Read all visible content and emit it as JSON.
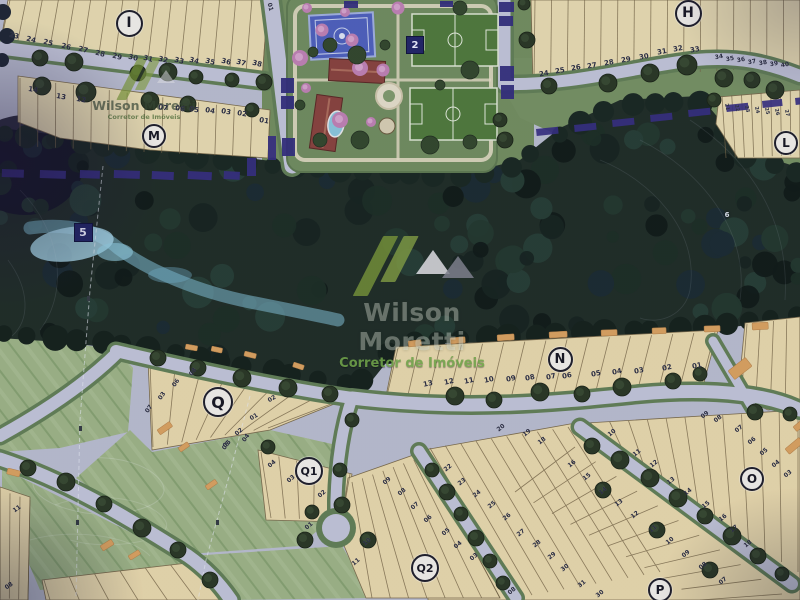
{
  "map_title": "Loteamento masterplan aerial site plan",
  "watermark": {
    "name": "Wilson Moretti",
    "tagline": "Corretor de Imóveis"
  },
  "colors": {
    "lot_fill": "#e8dbaa",
    "road": "#c2c5d9",
    "verge": "#5e7f50",
    "forest": "#1b2a21",
    "creek": "#a5dcec",
    "field": "#9cb580",
    "orange_marker": "#dfa055",
    "boundary_purple": "#332a84",
    "badge_navy": "#1d2268",
    "sport_green": "#4b7a33",
    "court_blue": "#4a5fc2",
    "roof_red": "#8c4038",
    "logo_green": "#7e9c33"
  },
  "badges": [
    {
      "id": "block-I",
      "label": "I",
      "kind": "circle",
      "x": 127,
      "y": 21,
      "d": 23
    },
    {
      "id": "block-M",
      "label": "M",
      "kind": "circle",
      "x": 152,
      "y": 134,
      "d": 20
    },
    {
      "id": "block-H",
      "label": "H",
      "kind": "circle",
      "x": 686,
      "y": 11,
      "d": 23
    },
    {
      "id": "block-L",
      "label": "L",
      "kind": "circle",
      "x": 784,
      "y": 141,
      "d": 20
    },
    {
      "id": "block-N",
      "label": "N",
      "kind": "circle",
      "x": 558,
      "y": 357,
      "d": 21
    },
    {
      "id": "block-Q",
      "label": "Q",
      "kind": "circle",
      "x": 216,
      "y": 400,
      "d": 26
    },
    {
      "id": "block-Q1",
      "label": "Q1",
      "kind": "circle",
      "x": 307,
      "y": 469,
      "d": 24
    },
    {
      "id": "block-Q2",
      "label": "Q2",
      "kind": "circle",
      "x": 423,
      "y": 566,
      "d": 24
    },
    {
      "id": "block-O",
      "label": "O",
      "kind": "circle",
      "x": 750,
      "y": 477,
      "d": 20
    },
    {
      "id": "block-P",
      "label": "P",
      "kind": "circle",
      "x": 658,
      "y": 588,
      "d": 20
    },
    {
      "id": "area-2",
      "label": "2",
      "kind": "square",
      "x": 414,
      "y": 44,
      "d": 16
    },
    {
      "id": "area-5",
      "label": "5",
      "kind": "square",
      "x": 82,
      "y": 231,
      "d": 17
    },
    {
      "id": "area-6",
      "label": "6",
      "kind": "plain",
      "x": 727,
      "y": 215,
      "d": 12
    }
  ],
  "lot_numbers": [
    {
      "b": "I",
      "n": "23",
      "x": 14,
      "y": 36,
      "r": 14
    },
    {
      "b": "I",
      "n": "24",
      "x": 31,
      "y": 40,
      "r": 14
    },
    {
      "b": "I",
      "n": "25",
      "x": 48,
      "y": 43,
      "r": 14
    },
    {
      "b": "I",
      "n": "26",
      "x": 66,
      "y": 47,
      "r": 14
    },
    {
      "b": "I",
      "n": "27",
      "x": 83,
      "y": 50,
      "r": 14
    },
    {
      "b": "I",
      "n": "28",
      "x": 100,
      "y": 54,
      "r": 14
    },
    {
      "b": "I",
      "n": "29",
      "x": 117,
      "y": 57,
      "r": 14
    },
    {
      "b": "I",
      "n": "30",
      "x": 133,
      "y": 58,
      "r": 14
    },
    {
      "b": "I",
      "n": "31",
      "x": 148,
      "y": 59,
      "r": 14
    },
    {
      "b": "I",
      "n": "32",
      "x": 163,
      "y": 60,
      "r": 14
    },
    {
      "b": "I",
      "n": "33",
      "x": 179,
      "y": 61,
      "r": 14
    },
    {
      "b": "I",
      "n": "34",
      "x": 194,
      "y": 61,
      "r": 14
    },
    {
      "b": "I",
      "n": "35",
      "x": 210,
      "y": 62,
      "r": 14
    },
    {
      "b": "I",
      "n": "36",
      "x": 226,
      "y": 62,
      "r": 14
    },
    {
      "b": "I",
      "n": "37",
      "x": 241,
      "y": 63,
      "r": 14
    },
    {
      "b": "I",
      "n": "38",
      "x": 257,
      "y": 64,
      "r": 14
    },
    {
      "b": "I",
      "n": "01",
      "x": 270,
      "y": 7,
      "r": 75,
      "s": 6
    },
    {
      "b": "M",
      "n": "14",
      "x": 33,
      "y": 90,
      "r": 10
    },
    {
      "b": "M",
      "n": "13",
      "x": 61,
      "y": 97,
      "r": 10
    },
    {
      "b": "M",
      "n": "12",
      "x": 81,
      "y": 100,
      "r": 10
    },
    {
      "b": "M",
      "n": "07",
      "x": 163,
      "y": 108,
      "r": 10
    },
    {
      "b": "M",
      "n": "06",
      "x": 180,
      "y": 109,
      "r": 10
    },
    {
      "b": "M",
      "n": "05",
      "x": 194,
      "y": 110,
      "r": 10
    },
    {
      "b": "M",
      "n": "04",
      "x": 210,
      "y": 111,
      "r": 10
    },
    {
      "b": "M",
      "n": "03",
      "x": 226,
      "y": 112,
      "r": 10
    },
    {
      "b": "M",
      "n": "02",
      "x": 242,
      "y": 114,
      "r": 10
    },
    {
      "b": "M",
      "n": "01",
      "x": 264,
      "y": 121,
      "r": 10
    },
    {
      "b": "H",
      "n": "24",
      "x": 544,
      "y": 74,
      "r": -10
    },
    {
      "b": "H",
      "n": "25",
      "x": 560,
      "y": 71,
      "r": -10
    },
    {
      "b": "H",
      "n": "26",
      "x": 576,
      "y": 68,
      "r": -10
    },
    {
      "b": "H",
      "n": "27",
      "x": 592,
      "y": 66,
      "r": -10
    },
    {
      "b": "H",
      "n": "28",
      "x": 609,
      "y": 63,
      "r": -10
    },
    {
      "b": "H",
      "n": "29",
      "x": 626,
      "y": 60,
      "r": -10
    },
    {
      "b": "H",
      "n": "30",
      "x": 644,
      "y": 57,
      "r": -10
    },
    {
      "b": "H",
      "n": "31",
      "x": 662,
      "y": 52,
      "r": -10
    },
    {
      "b": "H",
      "n": "32",
      "x": 678,
      "y": 49,
      "r": -10
    },
    {
      "b": "H",
      "n": "33",
      "x": 695,
      "y": 50,
      "r": -10
    },
    {
      "b": "H",
      "n": "34",
      "x": 719,
      "y": 57,
      "r": -10,
      "s": 6
    },
    {
      "b": "H",
      "n": "35",
      "x": 730,
      "y": 59,
      "r": -10,
      "s": 6
    },
    {
      "b": "H",
      "n": "36",
      "x": 741,
      "y": 60,
      "r": -10,
      "s": 6
    },
    {
      "b": "H",
      "n": "37",
      "x": 752,
      "y": 62,
      "r": -10,
      "s": 6
    },
    {
      "b": "H",
      "n": "38",
      "x": 763,
      "y": 63,
      "r": -10,
      "s": 6
    },
    {
      "b": "H",
      "n": "39",
      "x": 774,
      "y": 64,
      "r": -10,
      "s": 6
    },
    {
      "b": "H",
      "n": "40",
      "x": 785,
      "y": 65,
      "r": -10,
      "s": 6
    },
    {
      "b": "L",
      "n": "21",
      "x": 727,
      "y": 107,
      "r": 78,
      "s": 5
    },
    {
      "b": "L",
      "n": "22",
      "x": 737,
      "y": 108,
      "r": 78,
      "s": 5
    },
    {
      "b": "L",
      "n": "23",
      "x": 747,
      "y": 109,
      "r": 78,
      "s": 5
    },
    {
      "b": "L",
      "n": "24",
      "x": 757,
      "y": 110,
      "r": 78,
      "s": 5
    },
    {
      "b": "L",
      "n": "25",
      "x": 767,
      "y": 111,
      "r": 78,
      "s": 5
    },
    {
      "b": "L",
      "n": "26",
      "x": 777,
      "y": 112,
      "r": 78,
      "s": 5
    },
    {
      "b": "L",
      "n": "27",
      "x": 787,
      "y": 113,
      "r": 78,
      "s": 5
    },
    {
      "b": "N",
      "n": "13",
      "x": 428,
      "y": 384,
      "r": -12
    },
    {
      "b": "N",
      "n": "12",
      "x": 449,
      "y": 382,
      "r": -12
    },
    {
      "b": "N",
      "n": "11",
      "x": 469,
      "y": 381,
      "r": -12
    },
    {
      "b": "N",
      "n": "10",
      "x": 489,
      "y": 380,
      "r": -12
    },
    {
      "b": "N",
      "n": "09",
      "x": 511,
      "y": 379,
      "r": -12
    },
    {
      "b": "N",
      "n": "08",
      "x": 530,
      "y": 378,
      "r": -12
    },
    {
      "b": "N",
      "n": "07",
      "x": 551,
      "y": 377,
      "r": -12
    },
    {
      "b": "N",
      "n": "06",
      "x": 567,
      "y": 376,
      "r": -12
    },
    {
      "b": "N",
      "n": "05",
      "x": 596,
      "y": 374,
      "r": -12
    },
    {
      "b": "N",
      "n": "04",
      "x": 617,
      "y": 372,
      "r": -12
    },
    {
      "b": "N",
      "n": "03",
      "x": 639,
      "y": 371,
      "r": -12
    },
    {
      "b": "N",
      "n": "02",
      "x": 667,
      "y": 368,
      "r": -12
    },
    {
      "b": "N",
      "n": "01",
      "x": 697,
      "y": 366,
      "r": -12
    },
    {
      "b": "R",
      "n": "20",
      "x": 501,
      "y": 428,
      "r": -38,
      "s": 6
    },
    {
      "b": "R",
      "n": "19",
      "x": 527,
      "y": 433,
      "r": -38,
      "s": 6
    },
    {
      "b": "R",
      "n": "18",
      "x": 542,
      "y": 441,
      "r": -38,
      "s": 6
    },
    {
      "b": "R",
      "n": "22",
      "x": 448,
      "y": 468,
      "r": -38,
      "s": 6
    },
    {
      "b": "R",
      "n": "23",
      "x": 462,
      "y": 482,
      "r": -38,
      "s": 6
    },
    {
      "b": "R",
      "n": "24",
      "x": 477,
      "y": 494,
      "r": -38,
      "s": 6
    },
    {
      "b": "R",
      "n": "25",
      "x": 492,
      "y": 505,
      "r": -38,
      "s": 6
    },
    {
      "b": "R",
      "n": "26",
      "x": 507,
      "y": 517,
      "r": -38,
      "s": 6
    },
    {
      "b": "R",
      "n": "27",
      "x": 521,
      "y": 533,
      "r": -38,
      "s": 6
    },
    {
      "b": "R",
      "n": "28",
      "x": 537,
      "y": 544,
      "r": -38,
      "s": 6
    },
    {
      "b": "R",
      "n": "29",
      "x": 552,
      "y": 556,
      "r": -38,
      "s": 6
    },
    {
      "b": "R",
      "n": "30",
      "x": 565,
      "y": 568,
      "r": -38,
      "s": 6
    },
    {
      "b": "O",
      "n": "10",
      "x": 612,
      "y": 433,
      "r": -38,
      "s": 6
    },
    {
      "b": "O",
      "n": "11",
      "x": 637,
      "y": 453,
      "r": -38,
      "s": 6
    },
    {
      "b": "O",
      "n": "12",
      "x": 654,
      "y": 464,
      "r": -38,
      "s": 6
    },
    {
      "b": "O",
      "n": "13",
      "x": 671,
      "y": 481,
      "r": -38,
      "s": 6
    },
    {
      "b": "O",
      "n": "14",
      "x": 688,
      "y": 492,
      "r": -38,
      "s": 6
    },
    {
      "b": "O",
      "n": "15",
      "x": 706,
      "y": 505,
      "r": -38,
      "s": 6
    },
    {
      "b": "O",
      "n": "16",
      "x": 723,
      "y": 518,
      "r": -38,
      "s": 6
    },
    {
      "b": "O",
      "n": "17",
      "x": 734,
      "y": 529,
      "r": -38,
      "s": 6
    },
    {
      "b": "O",
      "n": "18",
      "x": 748,
      "y": 544,
      "r": -38,
      "s": 6
    },
    {
      "b": "O",
      "n": "09",
      "x": 705,
      "y": 415,
      "r": -38,
      "s": 6
    },
    {
      "b": "O",
      "n": "08",
      "x": 718,
      "y": 419,
      "r": -38,
      "s": 6
    },
    {
      "b": "O",
      "n": "07",
      "x": 739,
      "y": 429,
      "r": -38,
      "s": 6
    },
    {
      "b": "O",
      "n": "06",
      "x": 752,
      "y": 441,
      "r": -38,
      "s": 6
    },
    {
      "b": "O",
      "n": "05",
      "x": 764,
      "y": 452,
      "r": -38,
      "s": 6
    },
    {
      "b": "O",
      "n": "04",
      "x": 776,
      "y": 464,
      "r": -38,
      "s": 6
    },
    {
      "b": "O",
      "n": "03",
      "x": 788,
      "y": 474,
      "r": -38,
      "s": 6
    },
    {
      "b": "P",
      "n": "16",
      "x": 572,
      "y": 464,
      "r": -38,
      "s": 6
    },
    {
      "b": "P",
      "n": "15",
      "x": 587,
      "y": 477,
      "r": -38,
      "s": 6
    },
    {
      "b": "P",
      "n": "14",
      "x": 603,
      "y": 491,
      "r": -38,
      "s": 6
    },
    {
      "b": "P",
      "n": "13",
      "x": 619,
      "y": 503,
      "r": -38,
      "s": 6
    },
    {
      "b": "P",
      "n": "12",
      "x": 635,
      "y": 515,
      "r": -38,
      "s": 6
    },
    {
      "b": "P",
      "n": "11",
      "x": 653,
      "y": 529,
      "r": -38,
      "s": 6
    },
    {
      "b": "P",
      "n": "10",
      "x": 670,
      "y": 541,
      "r": -38,
      "s": 6
    },
    {
      "b": "P",
      "n": "09",
      "x": 686,
      "y": 554,
      "r": -38,
      "s": 6
    },
    {
      "b": "P",
      "n": "08",
      "x": 703,
      "y": 566,
      "r": -38,
      "s": 6
    },
    {
      "b": "P",
      "n": "07",
      "x": 723,
      "y": 581,
      "r": -38,
      "s": 6
    },
    {
      "b": "P",
      "n": "31",
      "x": 582,
      "y": 584,
      "r": -38,
      "s": 6
    },
    {
      "b": "P",
      "n": "30",
      "x": 600,
      "y": 594,
      "r": -38,
      "s": 6
    },
    {
      "b": "Q",
      "n": "08",
      "x": 193,
      "y": 372,
      "r": -55,
      "s": 6
    },
    {
      "b": "Q",
      "n": "06",
      "x": 176,
      "y": 383,
      "r": -55,
      "s": 6
    },
    {
      "b": "Q",
      "n": "03",
      "x": 162,
      "y": 396,
      "r": -55,
      "s": 6
    },
    {
      "b": "Q",
      "n": "07",
      "x": 149,
      "y": 409,
      "r": -55,
      "s": 6
    },
    {
      "b": "Q",
      "n": "05",
      "x": 226,
      "y": 446,
      "r": -55,
      "s": 6
    },
    {
      "b": "Q",
      "n": "04",
      "x": 246,
      "y": 438,
      "r": -55,
      "s": 6
    },
    {
      "b": "Q",
      "n": "02",
      "x": 272,
      "y": 399,
      "r": -30,
      "s": 6
    },
    {
      "b": "Q",
      "n": "01",
      "x": 254,
      "y": 417,
      "r": -30,
      "s": 6
    },
    {
      "b": "Q1",
      "n": "04",
      "x": 272,
      "y": 464,
      "r": -40,
      "s": 6
    },
    {
      "b": "Q1",
      "n": "03",
      "x": 291,
      "y": 479,
      "r": -40,
      "s": 6
    },
    {
      "b": "Q1",
      "n": "02",
      "x": 322,
      "y": 494,
      "r": -40,
      "s": 6
    },
    {
      "b": "Q1",
      "n": "01",
      "x": 309,
      "y": 526,
      "r": -40,
      "s": 6
    },
    {
      "b": "Q2",
      "n": "09",
      "x": 387,
      "y": 481,
      "r": -40,
      "s": 6
    },
    {
      "b": "Q2",
      "n": "08",
      "x": 402,
      "y": 492,
      "r": -40,
      "s": 6
    },
    {
      "b": "Q2",
      "n": "07",
      "x": 415,
      "y": 506,
      "r": -40,
      "s": 6
    },
    {
      "b": "Q2",
      "n": "06",
      "x": 428,
      "y": 519,
      "r": -40,
      "s": 6
    },
    {
      "b": "Q2",
      "n": "05",
      "x": 446,
      "y": 532,
      "r": -40,
      "s": 6
    },
    {
      "b": "Q2",
      "n": "04",
      "x": 458,
      "y": 545,
      "r": -40,
      "s": 6
    },
    {
      "b": "Q2",
      "n": "03",
      "x": 474,
      "y": 557,
      "r": -40,
      "s": 6
    },
    {
      "b": "Q2",
      "n": "10",
      "x": 367,
      "y": 542,
      "r": -40,
      "s": 6
    },
    {
      "b": "Q2",
      "n": "11",
      "x": 356,
      "y": 562,
      "r": -40,
      "s": 6
    },
    {
      "b": "Q2",
      "n": "08",
      "x": 512,
      "y": 591,
      "r": -40,
      "s": 6
    },
    {
      "b": "W",
      "n": "11",
      "x": 17,
      "y": 509,
      "r": -35,
      "s": 6
    },
    {
      "b": "W",
      "n": "08",
      "x": 9,
      "y": 586,
      "r": -35,
      "s": 6
    },
    {
      "b": "W",
      "n": "02",
      "x": 239,
      "y": 432,
      "r": -40,
      "s": 6
    },
    {
      "b": "W",
      "n": "05",
      "x": 227,
      "y": 444,
      "r": -40,
      "s": 6
    }
  ]
}
